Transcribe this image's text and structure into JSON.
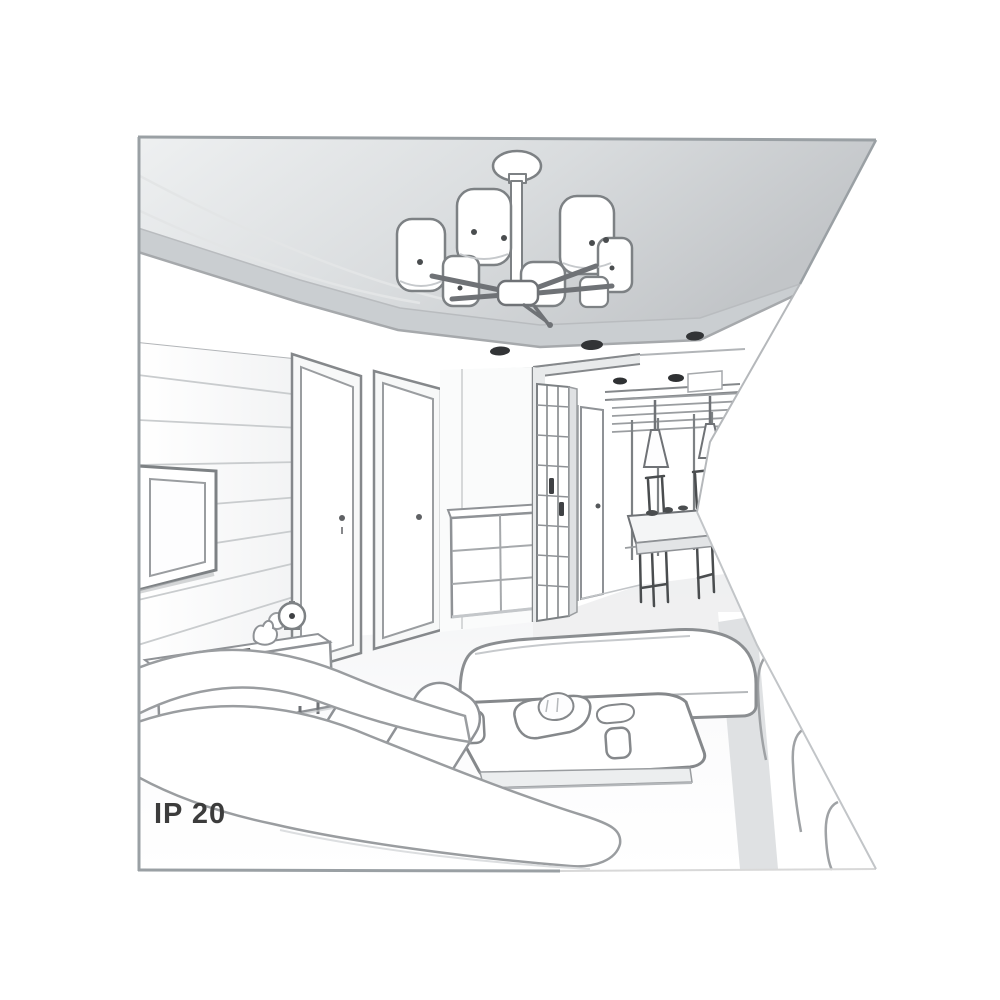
{
  "page": {
    "width": 1000,
    "height": 1000,
    "background": "#ffffff"
  },
  "illustration": {
    "label": "IP 20",
    "label_color": "#3c3c3c",
    "style": "grayscale line-art interior perspective sketch with triangular notch cut into right edge",
    "outline_color": "#8f9296",
    "ceiling_panel_color": "#c7cacd",
    "elements": [
      "suspended ceiling panel with recessed spotlights",
      "six-shade cylinder chandelier on central hub",
      "slatted tv wall with flat tv",
      "media sideboard with remote, figurine and alarm clock",
      "two interior doors with handles",
      "chest of drawers",
      "hallway with lattice wardrobe and inner door",
      "dining nook with window blinds, two cone pendant lamps, table and chairs",
      "three white sofas around a coffee table",
      "coffee table with two cups, plate with croissant and small dish"
    ]
  }
}
